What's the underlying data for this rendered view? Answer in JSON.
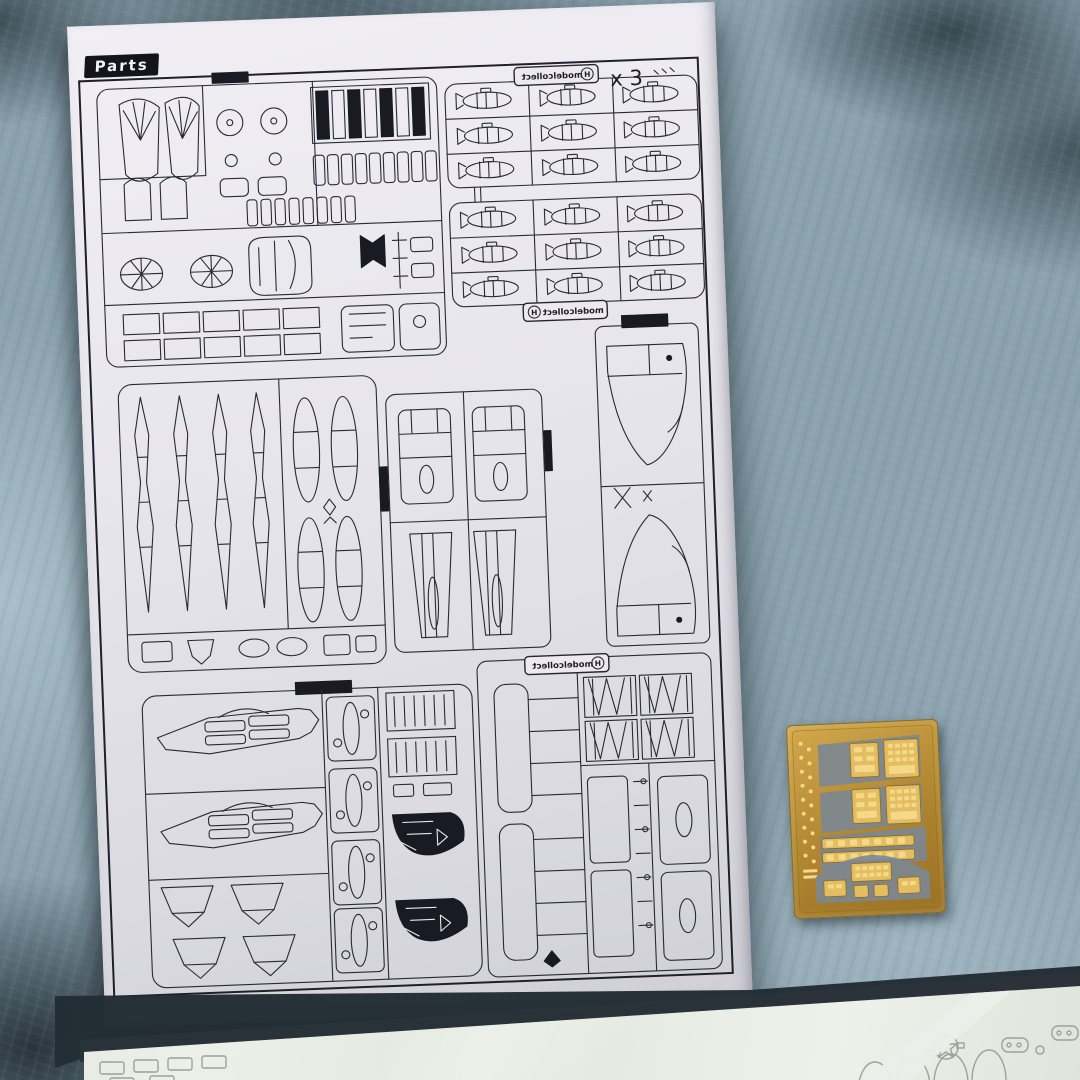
{
  "scene": {
    "subject": "model kit instruction parts page with photo-etch fret and bagged decal sheet on a fleece blanket"
  },
  "page": {
    "label": "Parts",
    "quantity_note": "x 3",
    "brand_label": "modelcollect",
    "brand_mark": "H"
  },
  "colors": {
    "blanket": "#8aa2ae",
    "paper": "#e7e6ec",
    "ink": "#2a2a34",
    "brass": "#bc913a",
    "decal_sheet": "#e7ece2"
  }
}
